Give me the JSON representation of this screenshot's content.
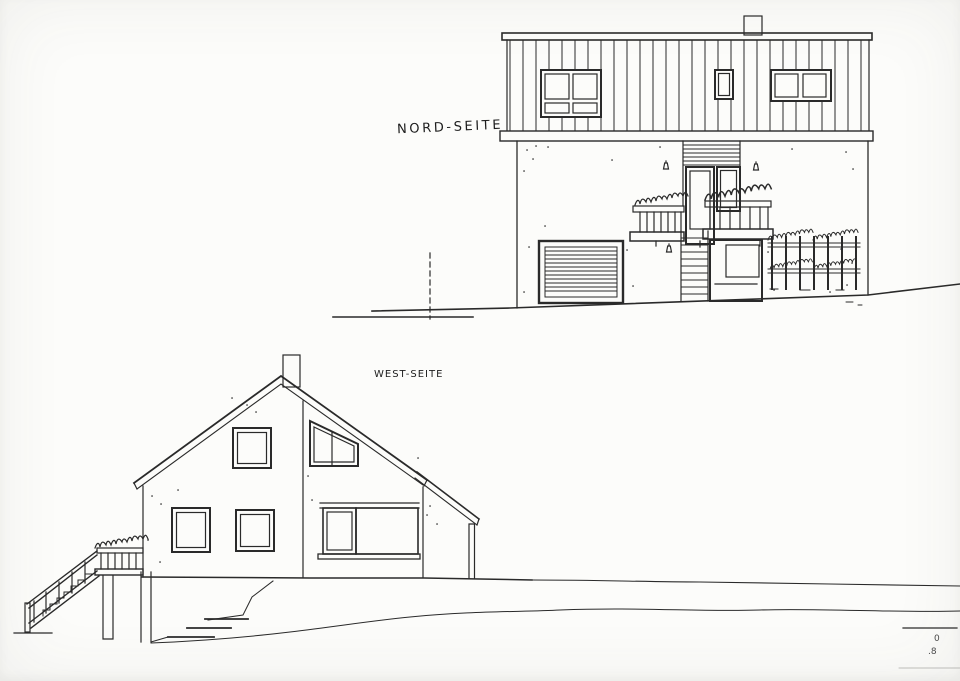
{
  "drawing": {
    "paper_color": "#fcfcfa",
    "ink_color": "#2a2a2a",
    "elevations": [
      {
        "id": "north",
        "label": "NORD-SEITE"
      },
      {
        "id": "west",
        "label": "WEST-SEITE"
      }
    ],
    "title_block_fragments": {
      "line1": "0",
      "line2": ".8"
    }
  }
}
